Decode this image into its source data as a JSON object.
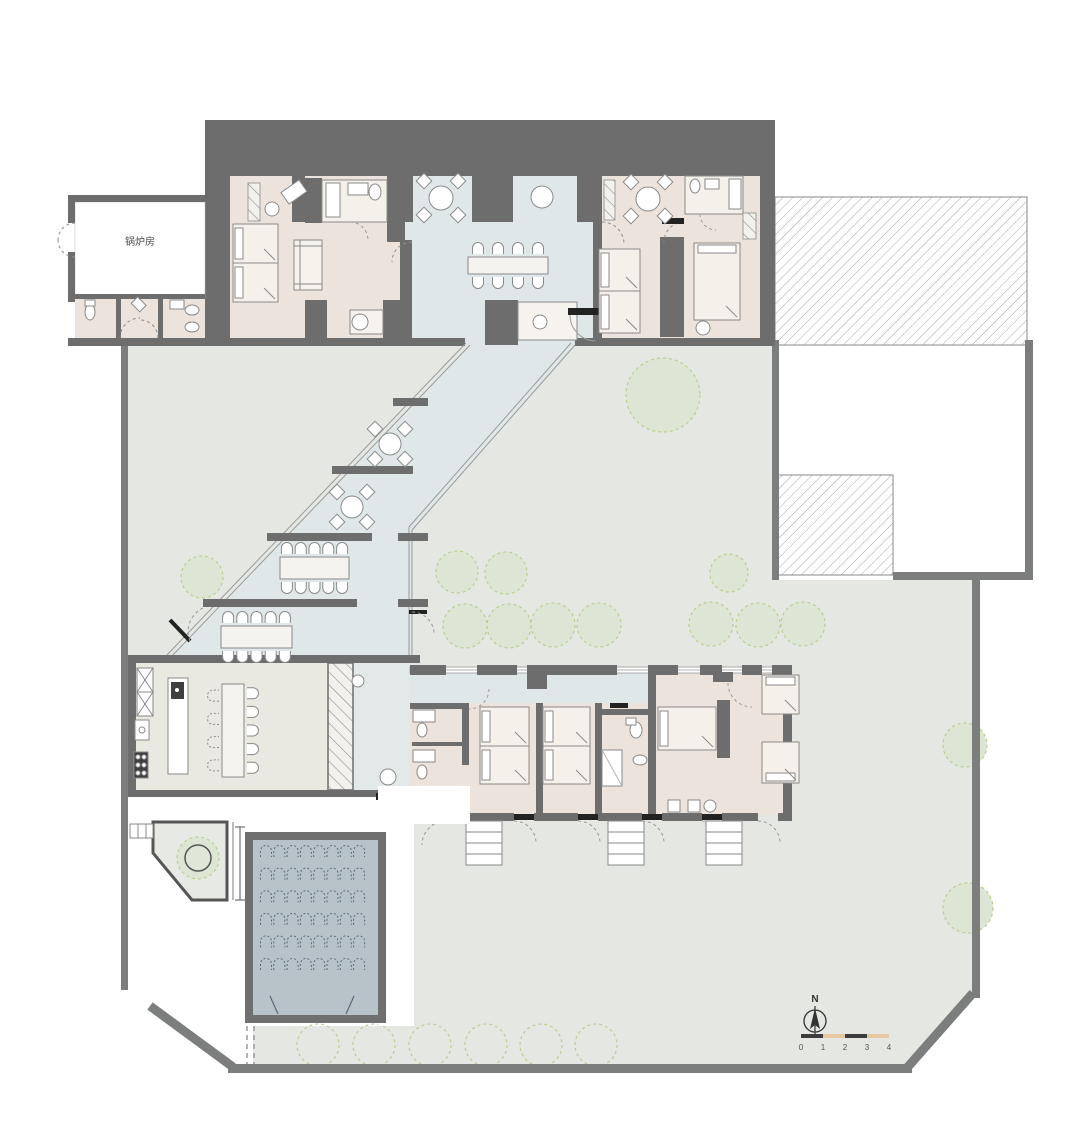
{
  "plan": {
    "boiler_room_label": "锅炉房",
    "north_label": "N",
    "scale_bar": {
      "labels": [
        "0",
        "1",
        "2",
        "3",
        "4"
      ],
      "origin_x": 801,
      "y": 1034,
      "seg_w": 22,
      "seg_h": 4,
      "label_y": 1050,
      "seg_colors": [
        "#3c3c3c",
        "#e6c8a2",
        "#3c3c3c",
        "#e6c8a2"
      ]
    },
    "colors": {
      "wall": "#6d6d6d",
      "site": "#7c7e7d",
      "lawn": "#e4e7e2",
      "blue": "#dfe7e9",
      "pink": "#ece3dc",
      "kitchen": "#e9e8e1",
      "hall_floor": "#b7c2c9",
      "tree_fill": "#dde6d4",
      "tree_edge": "#b9d08f",
      "furn": "#8a8a8a",
      "dark": "#222222",
      "dim": "#4a4a4a",
      "chair_hall": "#5c6a73"
    },
    "trees_filled": [
      [
        663,
        395,
        37
      ],
      [
        202,
        577,
        21
      ],
      [
        457,
        572,
        21
      ],
      [
        506,
        573,
        21
      ],
      [
        465,
        626,
        22
      ],
      [
        509,
        626,
        22
      ],
      [
        553,
        625,
        22
      ],
      [
        599,
        625,
        22
      ],
      [
        729,
        573,
        19
      ],
      [
        711,
        624,
        22
      ],
      [
        758,
        625,
        22
      ],
      [
        803,
        624,
        22
      ],
      [
        965,
        745,
        22
      ],
      [
        968,
        908,
        25
      ]
    ],
    "trees_outline": [
      [
        318,
        1045,
        21
      ],
      [
        374,
        1045,
        21
      ],
      [
        430,
        1045,
        21
      ],
      [
        486,
        1045,
        21
      ],
      [
        541,
        1045,
        21
      ],
      [
        596,
        1045,
        21
      ]
    ],
    "planter_tree": {
      "x": 198,
      "y": 858,
      "r_outer": 21,
      "r_inner": 13
    },
    "auditorium_chairs": {
      "rows": 6,
      "cols": 8,
      "x0": 266,
      "y0": 852,
      "dx": 13.3,
      "dy": 22.6
    },
    "long_tables": [
      {
        "x": 468,
        "y": 257,
        "w": 80,
        "h": 17,
        "o": "h",
        "a": 4,
        "b": 4
      },
      {
        "x": 280,
        "y": 557,
        "w": 69,
        "h": 22,
        "o": "h",
        "a": 5,
        "b": 5
      },
      {
        "x": 221,
        "y": 626,
        "w": 71,
        "h": 22,
        "o": "h",
        "a": 5,
        "b": 5
      },
      {
        "x": 222,
        "y": 684,
        "w": 22,
        "h": 93,
        "o": "v",
        "a": 4,
        "b": 5,
        "dashA": true
      }
    ],
    "round_tables": [
      {
        "x": 441,
        "y": 198,
        "r": 12,
        "c": 4,
        "s": 17
      },
      {
        "x": 542,
        "y": 197,
        "r": 11,
        "c": 0,
        "s": 0
      },
      {
        "x": 648,
        "y": 199,
        "r": 12,
        "c": 4,
        "s": 17
      },
      {
        "x": 390,
        "y": 444,
        "r": 11,
        "c": 4,
        "s": 15
      },
      {
        "x": 352,
        "y": 507,
        "r": 11,
        "c": 4,
        "s": 15
      },
      {
        "x": 388,
        "y": 777,
        "r": 8,
        "c": 0,
        "s": 0
      },
      {
        "x": 540,
        "y": 322,
        "r": 7,
        "c": 0,
        "s": 0
      },
      {
        "x": 272,
        "y": 209,
        "r": 7,
        "c": 0,
        "s": 0
      },
      {
        "x": 360,
        "y": 322,
        "r": 8,
        "c": 0,
        "s": 0
      },
      {
        "x": 703,
        "y": 328,
        "r": 7,
        "c": 0,
        "s": 0
      },
      {
        "x": 358,
        "y": 681,
        "r": 6,
        "c": 0,
        "s": 0
      }
    ],
    "beds": [
      {
        "x": 233,
        "y": 224,
        "w": 45,
        "h": 39,
        "p": "l"
      },
      {
        "x": 233,
        "y": 263,
        "w": 45,
        "h": 39,
        "p": "l"
      },
      {
        "x": 599,
        "y": 249,
        "w": 41,
        "h": 42,
        "p": "l"
      },
      {
        "x": 599,
        "y": 291,
        "w": 41,
        "h": 42,
        "p": "l"
      },
      {
        "x": 694,
        "y": 243,
        "w": 46,
        "h": 77,
        "p": "t"
      },
      {
        "x": 480,
        "y": 707,
        "w": 49,
        "h": 39,
        "p": "l"
      },
      {
        "x": 480,
        "y": 746,
        "w": 49,
        "h": 38,
        "p": "l"
      },
      {
        "x": 543,
        "y": 707,
        "w": 47,
        "h": 39,
        "p": "l"
      },
      {
        "x": 543,
        "y": 746,
        "w": 47,
        "h": 38,
        "p": "l"
      },
      {
        "x": 658,
        "y": 707,
        "w": 58,
        "h": 43,
        "p": "l"
      },
      {
        "x": 762,
        "y": 675,
        "w": 37,
        "h": 39,
        "p": "t"
      },
      {
        "x": 762,
        "y": 742,
        "w": 37,
        "h": 41,
        "p": "b"
      }
    ]
  }
}
